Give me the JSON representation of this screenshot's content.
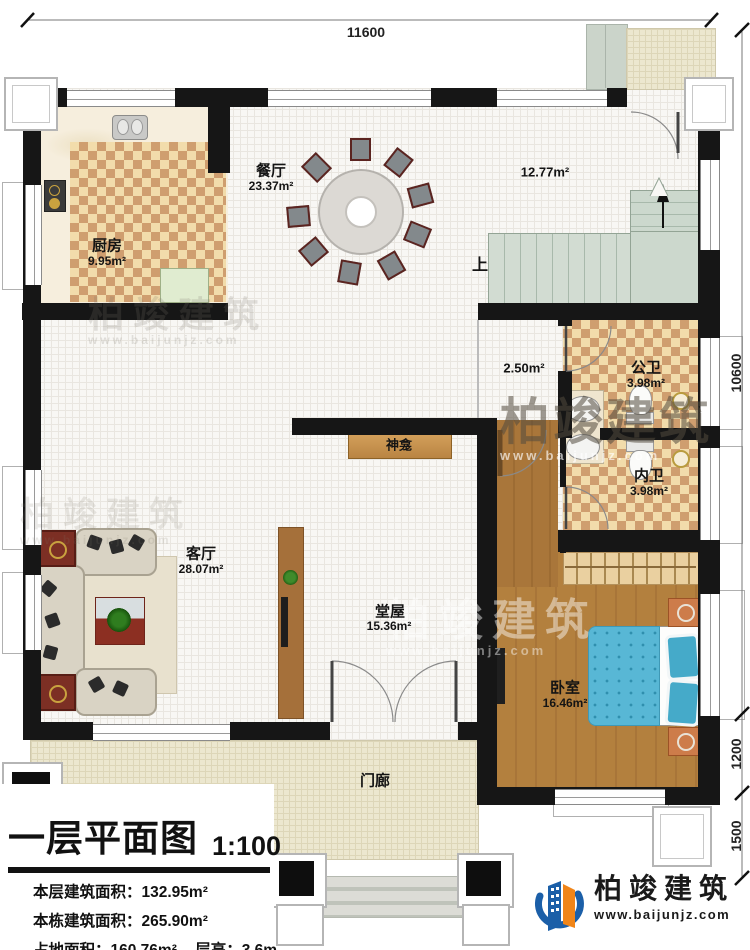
{
  "dimensions": {
    "top": "11600",
    "right_total": "10600",
    "right_mid": "1200",
    "right_bottom": "1500"
  },
  "rooms": {
    "kitchen": {
      "name": "厨房",
      "area": "9.95m²"
    },
    "dining": {
      "name": "餐厅",
      "area": "23.37m²"
    },
    "stair_hall": {
      "area": "12.77m²"
    },
    "passage": {
      "area": "2.50m²"
    },
    "public_bath": {
      "name": "公卫",
      "area": "3.98m²"
    },
    "ensuite_bath": {
      "name": "内卫",
      "area": "3.98m²"
    },
    "living": {
      "name": "客厅",
      "area": "28.07m²"
    },
    "main_hall": {
      "name": "堂屋",
      "area": "15.36m²"
    },
    "bedroom": {
      "name": "卧室",
      "area": "16.46m²"
    },
    "porch": {
      "name": "门廊"
    }
  },
  "annotations": {
    "stairs_up": "上",
    "shrine": "神龛"
  },
  "title_block": {
    "title": "一层平面图",
    "scale": "1:100",
    "stats": [
      {
        "label": "本层建筑面积：",
        "value": "132.95m²"
      },
      {
        "label": "本栋建筑面积：",
        "value": "265.90m²"
      },
      {
        "label": "占地面积：",
        "value": "160.76m²",
        "label2": "层高：",
        "value2": "3.6m"
      }
    ]
  },
  "logo": {
    "name": "柏竣建筑",
    "website": "www.baijunjz.com"
  },
  "watermark": {
    "text": "柏竣建筑",
    "website": "www.baijunjz.com"
  },
  "colors": {
    "wall": "#161616",
    "checker_dark": "#cf9e6f",
    "checker_light": "#f2dcab",
    "wood": "#b3803e",
    "stairs": "#ccd8cd",
    "bed_quilt": "#58b7d5",
    "porch": "#ece7cf",
    "logo_blue": "#1b5fa8",
    "logo_orange": "#f08519"
  }
}
